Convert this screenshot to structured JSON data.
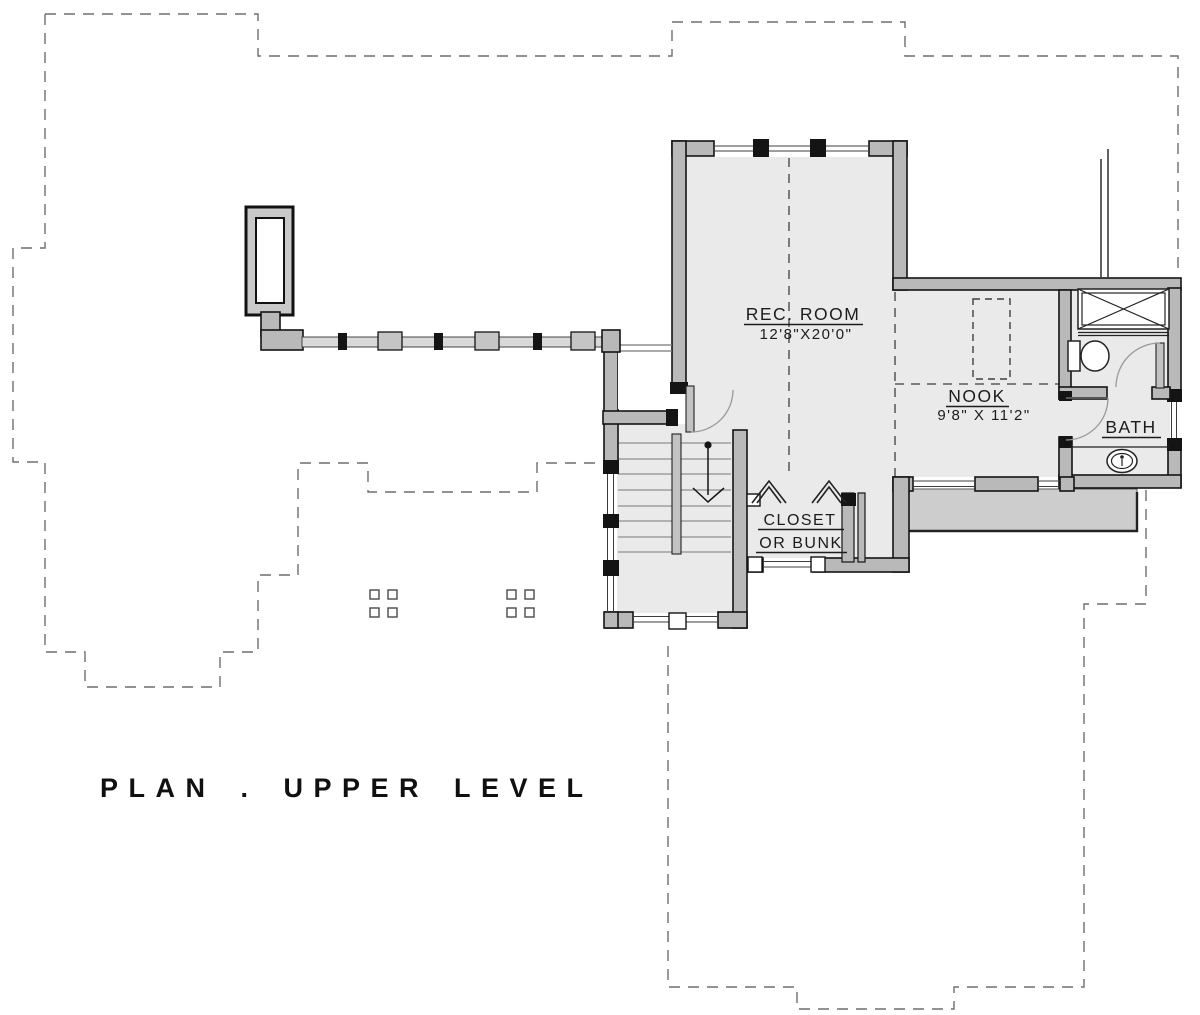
{
  "drawing": {
    "type": "architectural-floor-plan",
    "title": "PLAN . UPPER LEVEL",
    "rooms": {
      "rec_room": {
        "name": "REC. ROOM",
        "dims": "12'8\"X20'0\""
      },
      "nook": {
        "name": "NOOK",
        "dims": "9'8\" X 11'2\""
      },
      "bath": {
        "name": "BATH"
      },
      "closet": {
        "line1": "CLOSET",
        "line2": "OR BUNK"
      }
    },
    "colors": {
      "line": "#141414",
      "wall_fill": "#b9b9b9",
      "floor_fill": "#eaeaea",
      "deck_fill": "#cdcdcd",
      "dashed_outline": "#6e6e6e",
      "text": "#1c1c1c"
    }
  }
}
